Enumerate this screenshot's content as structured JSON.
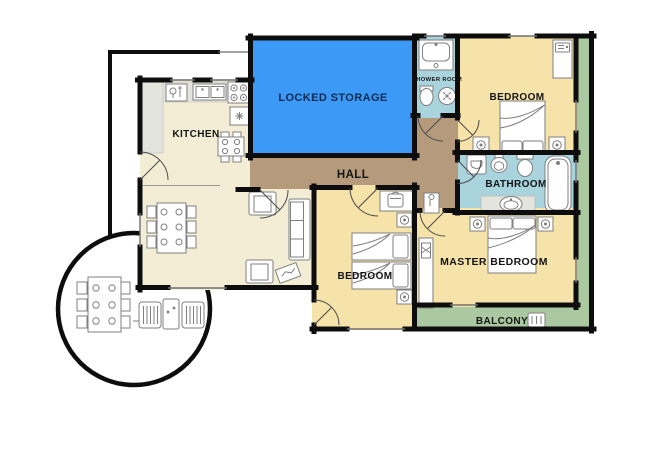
{
  "plan": {
    "type": "apartment-floor-plan",
    "rooms": {
      "kitchen": {
        "label": "KITCHEN"
      },
      "hall": {
        "label": "HALL"
      },
      "locked_storage": {
        "label": "LOCKED STORAGE"
      },
      "shower_room": {
        "label": "SHOWER ROOM"
      },
      "bedroom_top": {
        "label": "BEDROOM"
      },
      "bathroom": {
        "label": "BATHROOM"
      },
      "bedroom_middle": {
        "label": "BEDROOM"
      },
      "master_bedroom": {
        "label": "MASTER BEDROOM"
      },
      "balcony": {
        "label": "BALCONY"
      }
    },
    "furniture_icons": [
      "kitchen-counter",
      "kitchen-sink",
      "stove",
      "cooker-hood",
      "kitchen-table",
      "dining-table",
      "armchair",
      "sofa",
      "coffee-table",
      "patio-table",
      "lounge-chair",
      "patio-side-table",
      "washbasin",
      "toilet",
      "shower",
      "washing-machine",
      "bathtub",
      "vanity-basin",
      "double-bed",
      "single-bed",
      "nightstand-lamp",
      "wardrobe",
      "desk",
      "balcony-chair"
    ]
  },
  "colors": {
    "wall": "#0d0d0d",
    "living": "#f3edd6",
    "bedroom": "#f6e3a9",
    "wet_room": "#a9d4de",
    "hall": "#b59b7b",
    "storage": "#3d99f6",
    "balcony": "#abc9a0",
    "counter": "#e4e4df",
    "label": "#141414",
    "storage_label": "#0c2a52"
  }
}
